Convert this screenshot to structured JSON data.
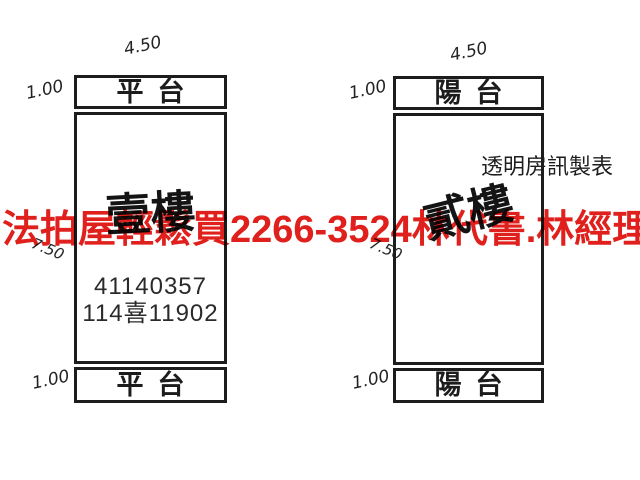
{
  "colors": {
    "ink": "#1c1c1c",
    "watermark_red": "#e0201c",
    "paper": "#ffffff"
  },
  "watermark": {
    "company": "法拍屋輕鬆買",
    "phone": "2266-3524",
    "contact": "林代書.林經理"
  },
  "maker_note": "透明房訊製表",
  "plans": [
    {
      "top_width_dim": "4.50",
      "top_strip": {
        "label": "平台",
        "depth_dim": "1.00"
      },
      "body": {
        "label": "壹樓",
        "height_dim": "7.50",
        "numbers": [
          "41140357",
          "114喜11902"
        ]
      },
      "bottom_strip": {
        "label": "平台",
        "depth_dim": "1.00"
      }
    },
    {
      "top_width_dim": "4.50",
      "top_strip": {
        "label": "陽台",
        "depth_dim": "1.00"
      },
      "body": {
        "label": "貳樓",
        "height_dim": "7.50"
      },
      "bottom_strip": {
        "label": "陽台",
        "depth_dim": "1.00"
      }
    }
  ]
}
